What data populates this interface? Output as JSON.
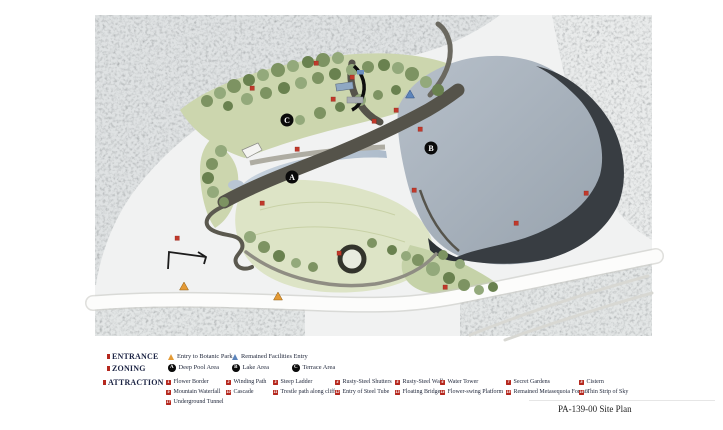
{
  "sheet": {
    "title": "PA-139-00 Site Plan"
  },
  "colors": {
    "attraction_badge": "#b5281e",
    "entrance_triangle": "#e49a35",
    "facility_triangle": "#5c84bb",
    "zone_marker": "#0a0a0a",
    "map_marker_red": "#c0392b",
    "lake": "#a4aeb9",
    "cliff": "#383d42",
    "lawn": "#dde4c6"
  },
  "legend": {
    "entrance": {
      "header": "ENTRANCE",
      "items": [
        {
          "label": "Entry to Botanic Park"
        },
        {
          "label": "Remained Facilities Entry"
        }
      ]
    },
    "zoning": {
      "header": "ZONING",
      "items": [
        {
          "code": "A",
          "label": "Deep Pool Area"
        },
        {
          "code": "B",
          "label": "Lake Area"
        },
        {
          "code": "C",
          "label": "Terrace Area"
        }
      ]
    },
    "attraction": {
      "header": "ATTRACTION",
      "items": [
        {
          "num": "1",
          "label": "Flower Border"
        },
        {
          "num": "2",
          "label": "Winding Path"
        },
        {
          "num": "3",
          "label": "Steep Ladder"
        },
        {
          "num": "4",
          "label": "Rusty-Steel Shutters"
        },
        {
          "num": "5",
          "label": "Rusty-Steel Wall"
        },
        {
          "num": "6",
          "label": "Water Tower"
        },
        {
          "num": "7",
          "label": "Secret Gardens"
        },
        {
          "num": "8",
          "label": "Cistern"
        },
        {
          "num": "9",
          "label": "Mountain Waterfall"
        },
        {
          "num": "10",
          "label": "Cascade"
        },
        {
          "num": "11",
          "label": "Trestle path along cliff"
        },
        {
          "num": "12",
          "label": "Entry of Steel Tube"
        },
        {
          "num": "13",
          "label": "Floating Bridge"
        },
        {
          "num": "14",
          "label": "Flower-swing Platform"
        },
        {
          "num": "15",
          "label": "Remained Metasequoia Forests"
        },
        {
          "num": "16",
          "label": "Thin Strip of Sky"
        },
        {
          "num": "17",
          "label": "Underground Tunnel"
        }
      ]
    }
  }
}
